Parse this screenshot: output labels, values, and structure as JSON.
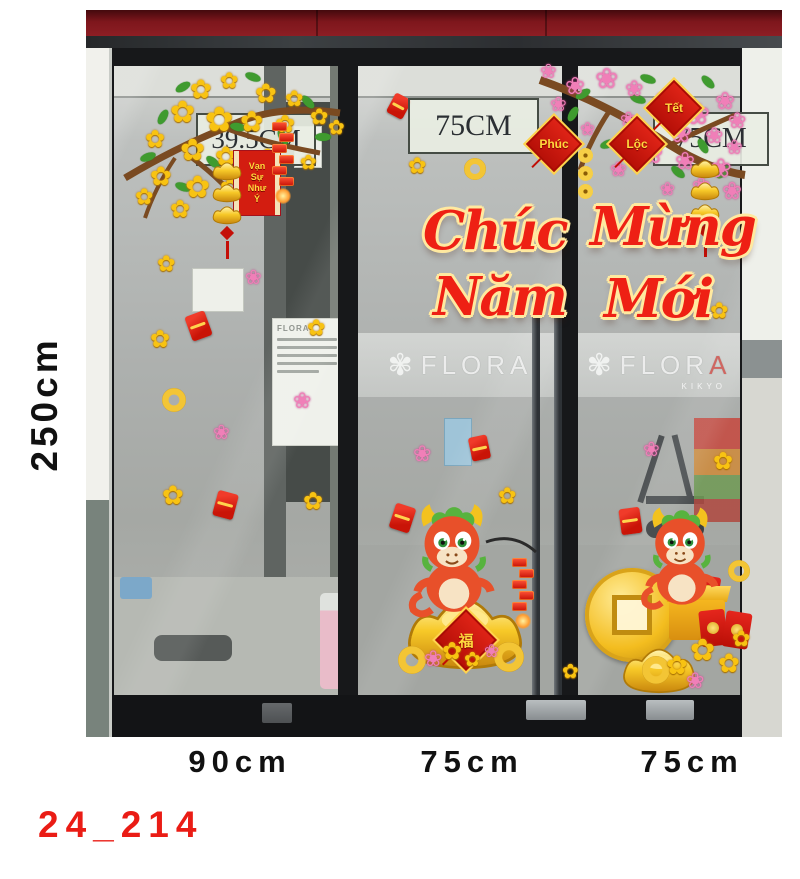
{
  "product_code": "24_214",
  "side_height_label": "250cm",
  "bottom_width_labels": [
    "90cm",
    "75cm",
    "75cm"
  ],
  "panel_labels": {
    "left": "39.5CM",
    "middle": "75CM",
    "right": "75CM"
  },
  "greeting": {
    "word1": "Chúc",
    "word2": "Mừng",
    "word3": "Năm",
    "word4": "Mới"
  },
  "hanging_tags": {
    "tet": "Tết",
    "phuc": "Phúc",
    "loc": "Lộc"
  },
  "scroll_banner": {
    "line1": "Vạn",
    "line2": "Sự",
    "line3": "Như",
    "line4": "Ý"
  },
  "storefront": {
    "brand": "FLORA",
    "brand_prefix": "FLOR",
    "brand_last": "A",
    "brand_sub": "KIKYO"
  },
  "colors": {
    "accent_red": "#ea1c15",
    "script_red": "#ee2014",
    "outline_gold": "#ffe9a0",
    "awning_red": "#7e161c",
    "flower_yellow": "#f8c312",
    "flower_pink": "#f07fb8",
    "gold": "#f3bd1f"
  },
  "decals": {
    "glyphs": {
      "yellow-flower": "✿",
      "pink-flower": "❀"
    },
    "scatter": [
      {
        "type": "yellow-flower",
        "x": 71,
        "y": 243,
        "s": 22
      },
      {
        "type": "yellow-flower",
        "x": 64,
        "y": 318,
        "s": 24
      },
      {
        "type": "yellow-flower",
        "x": 221,
        "y": 307,
        "s": 22
      },
      {
        "type": "yellow-flower",
        "x": 76,
        "y": 472,
        "s": 26
      },
      {
        "type": "yellow-flower",
        "x": 217,
        "y": 480,
        "s": 24
      },
      {
        "type": "yellow-flower",
        "x": 322,
        "y": 145,
        "s": 22
      },
      {
        "type": "yellow-flower",
        "x": 412,
        "y": 475,
        "s": 22
      },
      {
        "type": "yellow-flower",
        "x": 627,
        "y": 440,
        "s": 24
      },
      {
        "type": "yellow-flower",
        "x": 624,
        "y": 290,
        "s": 22
      },
      {
        "type": "yellow-flower",
        "x": 476,
        "y": 652,
        "s": 20
      },
      {
        "type": "pink-flower",
        "x": 159,
        "y": 258,
        "s": 20
      },
      {
        "type": "pink-flower",
        "x": 207,
        "y": 380,
        "s": 22
      },
      {
        "type": "pink-flower",
        "x": 127,
        "y": 413,
        "s": 20
      },
      {
        "type": "pink-flower",
        "x": 327,
        "y": 433,
        "s": 22
      },
      {
        "type": "pink-flower",
        "x": 557,
        "y": 430,
        "s": 20
      },
      {
        "type": "red-envelope",
        "x": 102,
        "y": 303,
        "s": 26,
        "r": -20
      },
      {
        "type": "red-envelope",
        "x": 129,
        "y": 482,
        "s": 26,
        "r": 15
      },
      {
        "type": "red-envelope",
        "x": 304,
        "y": 85,
        "s": 22,
        "r": 28
      },
      {
        "type": "red-envelope",
        "x": 384,
        "y": 426,
        "s": 24,
        "r": -12
      },
      {
        "type": "red-envelope",
        "x": 306,
        "y": 495,
        "s": 26,
        "r": 18
      },
      {
        "type": "red-envelope",
        "x": 534,
        "y": 498,
        "s": 26,
        "r": -8
      },
      {
        "type": "gold-coin",
        "x": 76,
        "y": 378,
        "s": 24
      },
      {
        "type": "gold-coin",
        "x": 378,
        "y": 148,
        "s": 22
      },
      {
        "type": "gold-coin",
        "x": 642,
        "y": 550,
        "s": 22
      }
    ]
  }
}
